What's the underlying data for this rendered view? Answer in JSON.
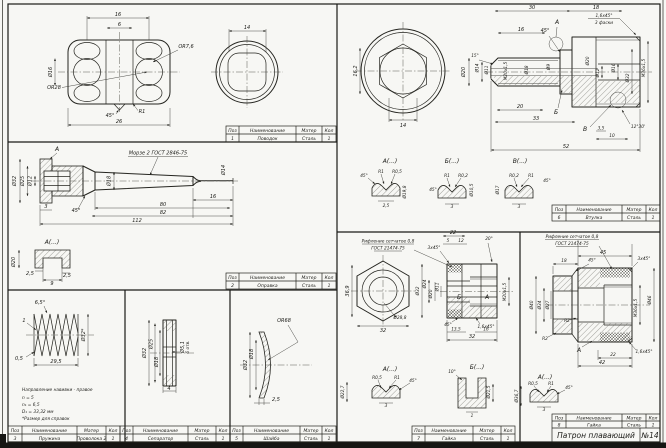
{
  "sheet": {
    "title": "Патрон плавающий",
    "number": "№14"
  },
  "colors": {
    "paper": "#f7f7f4",
    "ink": "#1b1b17"
  },
  "table": {
    "pos": "Поз",
    "name": "Наименование",
    "mat": "Матер",
    "qty": "Кол"
  },
  "parts": [
    {
      "pos": "1",
      "name": "Поводок",
      "mat": "Сталь",
      "qty": "1"
    },
    {
      "pos": "2",
      "name": "Оправка",
      "mat": "Сталь",
      "qty": "1"
    },
    {
      "pos": "3",
      "name": "Пружина",
      "mat": "Проволока 2",
      "qty": "1"
    },
    {
      "pos": "4",
      "name": "Сепаратор",
      "mat": "Сталь",
      "qty": "1"
    },
    {
      "pos": "5",
      "name": "Шайба",
      "mat": "Сталь",
      "qty": "1"
    },
    {
      "pos": "6",
      "name": "Втулка",
      "mat": "Сталь",
      "qty": "1"
    },
    {
      "pos": "7",
      "name": "Гайка",
      "mat": "Сталь",
      "qty": "1"
    },
    {
      "pos": "8",
      "name": "Гайка",
      "mat": "Сталь",
      "qty": "1"
    }
  ],
  "p1": {
    "n16": "16",
    "n6": "6",
    "d16": "Ø16",
    "r28": "OR28",
    "r76": "OR7,6",
    "r1": "R1",
    "a45": "45°",
    "n26": "26",
    "n14": "14"
  },
  "p2": {
    "view_a": "А",
    "taper": "Морзе 2 ГОСТ 2846-75",
    "d32": "Ø32",
    "d25": "Ø25",
    "d12": "Ø12",
    "d18": "Ø18",
    "d14": "Ø14",
    "n3": "3",
    "a45": "45°",
    "n16": "16",
    "n80": "80",
    "n82": "82",
    "n112": "112",
    "det_a": "А(...)",
    "d20": "Ø20",
    "c25a": "2,5",
    "c25b": "2,5",
    "n9": "9"
  },
  "p3": {
    "a65": "6,5°",
    "n1": "1",
    "n05": "0,5",
    "n295": "29,5",
    "d32": "Ø32*",
    "note1": "Направление навивки - правое",
    "note2": "n = 5",
    "note3": "n₁ = 6,5",
    "note4": "D₁ = 33,32 мм",
    "note5": "*Размер для справок"
  },
  "p4": {
    "d32": "Ø32",
    "d25": "Ø25",
    "d18": "Ø18",
    "d51": "Ø5,1",
    "holes": "6 отв.",
    "n4": "4"
  },
  "p5": {
    "r68": "OR68",
    "d32": "Ø32",
    "d18": "Ø18",
    "n25": "2,5"
  },
  "p6": {
    "n162": "16,2",
    "n14": "14",
    "n30": "30",
    "n18": "18",
    "cham": "1,6х45°",
    "cham2": "3 фаски",
    "view_a": "А",
    "a45": "45°",
    "n16": "16",
    "a15": "15°",
    "d20l": "Ø20",
    "d14": "Ø14",
    "d11": "Ø11",
    "m20": "М20х1,5",
    "d18": "Ø18",
    "d9": "Ø9",
    "d20r": "Ø20",
    "d12": "Ø12",
    "d16": "Ø16",
    "d32": "Ø32",
    "m36": "М36х1,5",
    "view_b": "Б",
    "view_v": "В",
    "n20": "20",
    "n33": "33",
    "n52": "52",
    "n35": "3,5",
    "n10": "10",
    "a1230": "12°30'",
    "det_a": "А(...)",
    "det_b": "Б(...)",
    "det_v": "В(...)",
    "da_a45": "45°",
    "da_r1": "R1",
    "da_r05": "R0,5",
    "da_25": "2,5",
    "da_d198": "Ø19,8",
    "db_a45": "45°",
    "db_r1": "R1",
    "db_r02": "R0,2",
    "db_d105": "Ø10,5",
    "db_3": "3",
    "dv_d17": "Ø17",
    "dv_r02": "R0,2",
    "dv_r1": "R1",
    "dv_a45": "45°",
    "dv_3": "3"
  },
  "p7": {
    "knurl1": "Рифление сетчатое 0,8",
    "knurl2": "ГОСТ 21474-75",
    "n369": "36,9",
    "n32": "32",
    "d288": "Ø28,8",
    "n22": "22",
    "n5": "5",
    "n12": "12",
    "a20": "20°",
    "cham3": "3х45°",
    "d32": "Ø32",
    "d24": "Ø24",
    "d20": "Ø20",
    "d11": "Ø11",
    "m20": "М20х1,5",
    "lbl_a": "А",
    "lbl_b": "Б",
    "a45": "45°",
    "cham16": "1,6х45°",
    "n135": "13,5",
    "n16": "16",
    "n32b": "32",
    "det_a": "А(...)",
    "det_b": "Б(...)",
    "da_d227": "Ø22,7",
    "da_r05": "R0,5",
    "da_r1": "R1",
    "da_a45": "45°",
    "da_3": "3",
    "db_a10": "10°",
    "db_d215": "Ø21,5",
    "db_1": "1"
  },
  "p8": {
    "knurl1": "Рифление сетчатое 0,8",
    "knurl2": "ГОСТ 21474-75",
    "n45": "45",
    "n18": "18",
    "a45": "45°",
    "cham3": "3х45°",
    "d40": "Ø40",
    "d34": "Ø34",
    "d27": "Ø27",
    "d46": "Ø46",
    "m36": "М36х1,5",
    "r2a": "R2",
    "r2b": "R2",
    "lbl_a": "А",
    "cham16": "1,6х45°",
    "n22": "22",
    "n42": "42",
    "det_a": "А(...)",
    "da_d367": "Ø36,7",
    "da_r05": "R0,5",
    "da_r1": "R1",
    "da_a45": "45°",
    "da_3": "3"
  }
}
